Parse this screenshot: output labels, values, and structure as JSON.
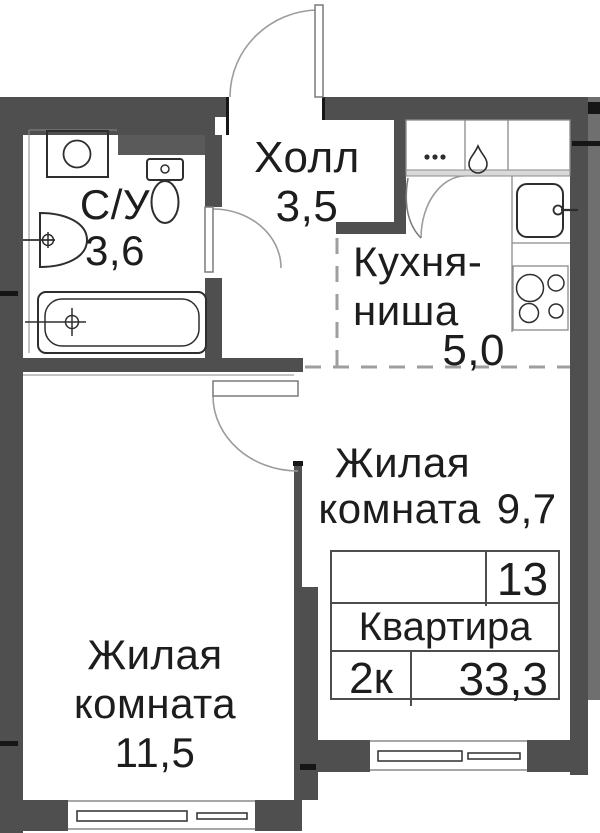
{
  "colors": {
    "wall": "#4f4f4f",
    "wall_outer": "#6f6f6f",
    "duct": "#5a5a5a",
    "text": "#1d1d1d",
    "dash": "#9e9e9e"
  },
  "rooms": {
    "bathroom": {
      "name": "С/У",
      "area": "3,6"
    },
    "hall": {
      "name": "Холл",
      "area": "3,5"
    },
    "kitchen_niche": {
      "name_line1": "Кухня-",
      "name_line2": "ниша",
      "area": "5,0"
    },
    "living_room_1": {
      "name_line1": "Жилая",
      "name_line2": "комната",
      "area": "9,7"
    },
    "living_room_2": {
      "name_line1": "Жилая",
      "name_line2": "комната",
      "area": "11,5"
    }
  },
  "info_table": {
    "floor_number": "13",
    "unit_label": "Квартира",
    "rooms_count": "2к",
    "total_area": "33,3"
  },
  "fixtures": [
    "washing-machine",
    "toilet",
    "wash-basin",
    "bathtub",
    "kitchen-sink",
    "stove-4-burners",
    "vent-dots",
    "water-drop",
    "entrance-door-swing",
    "bathroom-door-swing",
    "room-door-swing",
    "kitchen-door-swing",
    "window-living-room-1",
    "window-living-room-2"
  ]
}
